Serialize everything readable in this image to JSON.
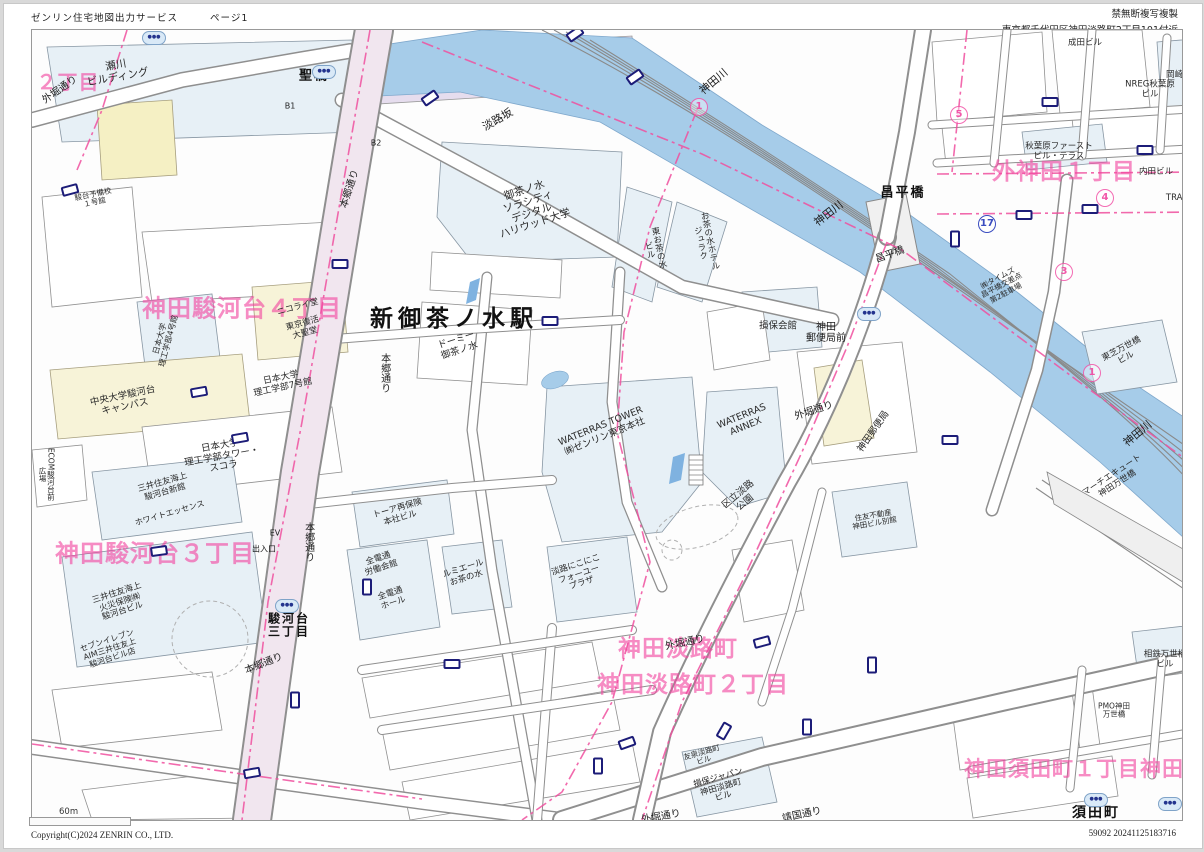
{
  "header": {
    "service_title": "ゼンリン住宅地図出力サービス",
    "page_label": "ページ1",
    "copy_notice": "禁無断複写複製",
    "address": "東京都千代田区神田淡路町2丁目101付近"
  },
  "footer": {
    "scale_label": "60m",
    "copyright": "Copyright(C)2024 ZENRIN CO., LTD.",
    "print_code": "59092 20241125183716"
  },
  "map": {
    "colors": {
      "river": "#a6cce9",
      "building_blue": "#e7f0f6",
      "building_cream": "#f7f3d8",
      "road_tint": "#f1e6ef",
      "district_pink": "#f246a0",
      "boundary_pink": "#f0509f",
      "marker_navy": "#1c1c78"
    },
    "labels": [
      {
        "t": "２丁目",
        "x": 66,
        "y": 80,
        "s": 20,
        "cls": "pink"
      },
      {
        "t": "神田駿河台４丁目",
        "x": 240,
        "y": 307,
        "s": 24,
        "cls": "pink"
      },
      {
        "t": "神田駿河台３丁目",
        "x": 153,
        "y": 552,
        "s": 24,
        "cls": "pink"
      },
      {
        "t": "外神田１丁目",
        "x": 1062,
        "y": 171,
        "s": 23,
        "cls": "pink"
      },
      {
        "t": "神田淡路町",
        "x": 676,
        "y": 648,
        "s": 23,
        "cls": "pink"
      },
      {
        "t": "神田淡路町２丁目",
        "x": 691,
        "y": 684,
        "s": 23,
        "cls": "pink"
      },
      {
        "t": "神田須田町１丁目神田須",
        "x": 1083,
        "y": 768,
        "s": 21,
        "cls": "pink"
      },
      {
        "t": "新御茶ノ水駅",
        "x": 452,
        "y": 318,
        "s": 23,
        "cls": "blk-xl",
        "n": "station-label"
      },
      {
        "t": "須田町",
        "x": 1094,
        "y": 812,
        "s": 14,
        "cls": "blk-l"
      },
      {
        "t": "聖橋",
        "x": 312,
        "y": 75,
        "s": 13,
        "cls": "blk-l"
      },
      {
        "t": "昌平橋",
        "x": 901,
        "y": 192,
        "s": 13,
        "cls": "blk-l"
      },
      {
        "t": "昌平橋",
        "x": 888,
        "y": 253,
        "s": 10,
        "r": -20,
        "cls": "blk"
      },
      {
        "t": "神田川",
        "x": 712,
        "y": 80,
        "s": 11,
        "r": -40,
        "cls": "blk"
      },
      {
        "t": "神田川",
        "x": 827,
        "y": 212,
        "s": 11,
        "r": -38,
        "cls": "blk"
      },
      {
        "t": "神田川",
        "x": 1136,
        "y": 432,
        "s": 11,
        "r": -40,
        "cls": "blk"
      },
      {
        "t": "淡路坂",
        "x": 496,
        "y": 118,
        "s": 11,
        "r": -30,
        "cls": "blk"
      },
      {
        "t": "本郷通り",
        "x": 348,
        "y": 187,
        "s": 10,
        "r": -72,
        "cls": "blk"
      },
      {
        "t": "本郷通り",
        "x": 382,
        "y": 371,
        "s": 10,
        "v": true,
        "cls": "blk"
      },
      {
        "t": "本郷通り",
        "x": 306,
        "y": 540,
        "s": 10,
        "v": true,
        "cls": "blk"
      },
      {
        "t": "本郷通り",
        "x": 262,
        "y": 662,
        "s": 10,
        "r": -22,
        "cls": "blk"
      },
      {
        "t": "外堀通り",
        "x": 58,
        "y": 88,
        "s": 10,
        "r": -35,
        "cls": "blk"
      },
      {
        "t": "外堀通り",
        "x": 812,
        "y": 409,
        "s": 10,
        "r": -18,
        "cls": "blk"
      },
      {
        "t": "外堀通り",
        "x": 683,
        "y": 641,
        "s": 10,
        "r": -12,
        "cls": "blk"
      },
      {
        "t": "外堀通り",
        "x": 659,
        "y": 815,
        "s": 10,
        "r": -10,
        "cls": "blk"
      },
      {
        "t": "靖国通り",
        "x": 800,
        "y": 813,
        "s": 10,
        "r": -12,
        "cls": "blk"
      },
      {
        "t": "駿河台\n三丁目",
        "x": 287,
        "y": 624,
        "s": 12,
        "cls": "blk-l"
      },
      {
        "t": "出入口",
        "x": 262,
        "y": 548,
        "s": 8,
        "cls": "blk"
      },
      {
        "t": "EV",
        "x": 273,
        "y": 532,
        "s": 8,
        "cls": "blk"
      },
      {
        "t": "B1",
        "x": 288,
        "y": 105,
        "s": 8,
        "cls": "blk"
      },
      {
        "t": "B2",
        "x": 374,
        "y": 142,
        "s": 8,
        "cls": "blk"
      },
      {
        "t": "御茶ノ水\nソラシティ\nデジタル\nハリウッド大学",
        "x": 528,
        "y": 206,
        "s": 10.5,
        "r": -18,
        "cls": "bld"
      },
      {
        "t": "東お茶の水\nビル",
        "x": 651,
        "y": 247,
        "s": 8.5,
        "r": -12,
        "v": true,
        "cls": "bld"
      },
      {
        "t": "お茶の水ホテル\nジュラク",
        "x": 702,
        "y": 240,
        "s": 8.5,
        "r": -12,
        "v": true,
        "cls": "bld"
      },
      {
        "t": "ドーミー\n御茶ノ水",
        "x": 456,
        "y": 344,
        "s": 9.5,
        "r": -18,
        "cls": "bld"
      },
      {
        "t": "WATERRAS TOWER\n㈱ゼンリン東京本社",
        "x": 601,
        "y": 430,
        "s": 9.5,
        "r": -22,
        "cls": "bld"
      },
      {
        "t": "WATERRAS\nANNEX",
        "x": 742,
        "y": 420,
        "s": 9.5,
        "r": -22,
        "cls": "bld"
      },
      {
        "t": "区立淡路\n公園",
        "x": 740,
        "y": 497,
        "s": 9.5,
        "r": -40,
        "cls": "bld"
      },
      {
        "t": "神田\n郵便局前",
        "x": 824,
        "y": 331,
        "s": 10,
        "cls": "blk"
      },
      {
        "t": "神田郵便局",
        "x": 872,
        "y": 430,
        "s": 9.5,
        "r": -55,
        "cls": "bld"
      },
      {
        "t": "損保会館",
        "x": 776,
        "y": 325,
        "s": 9.5,
        "cls": "bld"
      },
      {
        "t": "中央大学駿河台\nキャンパス",
        "x": 122,
        "y": 400,
        "s": 9.5,
        "r": -12,
        "cls": "bld"
      },
      {
        "t": "日本大学\n理工学部タワー・\nスコラ",
        "x": 220,
        "y": 455,
        "s": 9.5,
        "r": -10,
        "cls": "bld"
      },
      {
        "t": "日本大学\n理工学部7号館",
        "x": 280,
        "y": 381,
        "s": 9,
        "r": -12,
        "cls": "bld"
      },
      {
        "t": "日本大学\n理工学部4号館",
        "x": 163,
        "y": 338,
        "s": 8,
        "r": -75,
        "cls": "bld"
      },
      {
        "t": "ニコライ堂",
        "x": 296,
        "y": 306,
        "s": 8.5,
        "r": -15,
        "cls": "bld"
      },
      {
        "t": "東京復活\n大聖堂",
        "x": 302,
        "y": 327,
        "s": 8.5,
        "r": -15,
        "cls": "bld"
      },
      {
        "t": "三井住友海上\n火災保険㈱\n駿河台ビル",
        "x": 118,
        "y": 601,
        "s": 8.5,
        "r": -18,
        "cls": "bld"
      },
      {
        "t": "セブンイレブン\nAIM三井住友上\n駿河台ビル店",
        "x": 108,
        "y": 648,
        "s": 8,
        "r": -18,
        "cls": "bld"
      },
      {
        "t": "三井住友海上\n駿河台新館",
        "x": 162,
        "y": 486,
        "s": 8.5,
        "r": -16,
        "cls": "bld"
      },
      {
        "t": "ホワイトエッセンス",
        "x": 168,
        "y": 512,
        "s": 8,
        "r": -16,
        "cls": "bld"
      },
      {
        "t": "ECOM駿河台前\n広場",
        "x": 44,
        "y": 472,
        "s": 7.5,
        "v": true,
        "cls": "bld"
      },
      {
        "t": "全電通\n労働会館",
        "x": 378,
        "y": 562,
        "s": 8.5,
        "r": -18,
        "cls": "bld"
      },
      {
        "t": "全電通\nホール",
        "x": 390,
        "y": 597,
        "s": 8.5,
        "r": -18,
        "cls": "bld"
      },
      {
        "t": "トーア再保険\n本社ビル",
        "x": 397,
        "y": 512,
        "s": 8.5,
        "r": -16,
        "cls": "bld"
      },
      {
        "t": "ルミエール\nお茶の水",
        "x": 463,
        "y": 572,
        "s": 8.5,
        "r": -18,
        "cls": "bld"
      },
      {
        "t": "淡路にこにこ\nフォーユー\nプラザ",
        "x": 577,
        "y": 573,
        "s": 8.5,
        "r": -18,
        "cls": "bld"
      },
      {
        "t": "損保ジャパン\n神田淡路町\nビル",
        "x": 719,
        "y": 786,
        "s": 8.5,
        "r": -16,
        "cls": "bld"
      },
      {
        "t": "友泉淡路町\nビル",
        "x": 701,
        "y": 755,
        "s": 7.5,
        "r": -16,
        "cls": "bld"
      },
      {
        "t": "東芝万世橋\nビル",
        "x": 1122,
        "y": 352,
        "s": 8.5,
        "r": -28,
        "cls": "bld"
      },
      {
        "t": "マーチエキュート\n神田万世橋",
        "x": 1113,
        "y": 478,
        "s": 8.5,
        "r": -33,
        "cls": "bld"
      },
      {
        "t": "㈱タイムズ\n昌平橋交差点\n第2駐車場",
        "x": 1000,
        "y": 284,
        "s": 7.5,
        "r": -28,
        "cls": "bld"
      },
      {
        "t": "秋葉原ファースト\nビル・テラス",
        "x": 1057,
        "y": 150,
        "s": 8.5,
        "cls": "bld"
      },
      {
        "t": "内田ビル",
        "x": 1154,
        "y": 171,
        "s": 8.5,
        "cls": "bld"
      },
      {
        "t": "NREG秋葉原\nビル",
        "x": 1148,
        "y": 88,
        "s": 8.5,
        "cls": "bld"
      },
      {
        "t": "成田ビル",
        "x": 1083,
        "y": 42,
        "s": 8.5,
        "cls": "bld"
      },
      {
        "t": "岡崎ビル",
        "x": 1181,
        "y": 74,
        "s": 8.5,
        "cls": "bld"
      },
      {
        "t": "TRADERZ",
        "x": 1184,
        "y": 197,
        "s": 8.5,
        "cls": "bld"
      },
      {
        "t": "住友不動産\n神田ビル別館",
        "x": 872,
        "y": 518,
        "s": 7.5,
        "r": -10,
        "cls": "bld"
      },
      {
        "t": "相鉄万世橋\nビル",
        "x": 1163,
        "y": 658,
        "s": 8.5,
        "cls": "bld"
      },
      {
        "t": "PMO神田\n万世橋",
        "x": 1112,
        "y": 709,
        "s": 7.5,
        "cls": "bld"
      },
      {
        "t": "駿台予備校\n１号館",
        "x": 92,
        "y": 197,
        "s": 7.5,
        "r": -12,
        "cls": "bld"
      },
      {
        "t": "瀬川\nビルディング",
        "x": 115,
        "y": 70,
        "s": 10.5,
        "r": -10,
        "cls": "bld"
      }
    ],
    "circled_numbers": [
      {
        "n": "1",
        "x": 697,
        "y": 105,
        "c": "pink"
      },
      {
        "n": "5",
        "x": 957,
        "y": 113,
        "c": "pink"
      },
      {
        "n": "4",
        "x": 1103,
        "y": 196,
        "c": "pink"
      },
      {
        "n": "3",
        "x": 1062,
        "y": 270,
        "c": "pink"
      },
      {
        "n": "1",
        "x": 1090,
        "y": 371,
        "c": "pink"
      },
      {
        "n": "17",
        "x": 985,
        "y": 222,
        "c": "blue"
      }
    ],
    "subway_icons": [
      [
        152,
        36
      ],
      [
        322,
        70
      ],
      [
        867,
        312
      ],
      [
        285,
        604
      ],
      [
        1094,
        798
      ],
      [
        1168,
        802
      ]
    ],
    "crossing_markers": [
      [
        68,
        188,
        -15
      ],
      [
        197,
        390,
        -10
      ],
      [
        157,
        549,
        -8
      ],
      [
        548,
        319,
        0
      ],
      [
        428,
        96,
        -35
      ],
      [
        573,
        32,
        -35
      ],
      [
        633,
        75,
        -35
      ],
      [
        1048,
        100,
        0
      ],
      [
        1143,
        148,
        0
      ],
      [
        1088,
        207,
        0
      ],
      [
        1022,
        213,
        0
      ],
      [
        953,
        237,
        90
      ],
      [
        760,
        640,
        -15
      ],
      [
        722,
        729,
        -60
      ],
      [
        625,
        741,
        -20
      ],
      [
        596,
        764,
        90
      ],
      [
        365,
        585,
        90
      ],
      [
        238,
        436,
        -10
      ],
      [
        338,
        262,
        0
      ],
      [
        293,
        698,
        90
      ],
      [
        250,
        771,
        -10
      ],
      [
        450,
        662,
        0
      ],
      [
        805,
        725,
        90
      ],
      [
        948,
        438,
        0
      ],
      [
        870,
        663,
        90
      ]
    ]
  }
}
